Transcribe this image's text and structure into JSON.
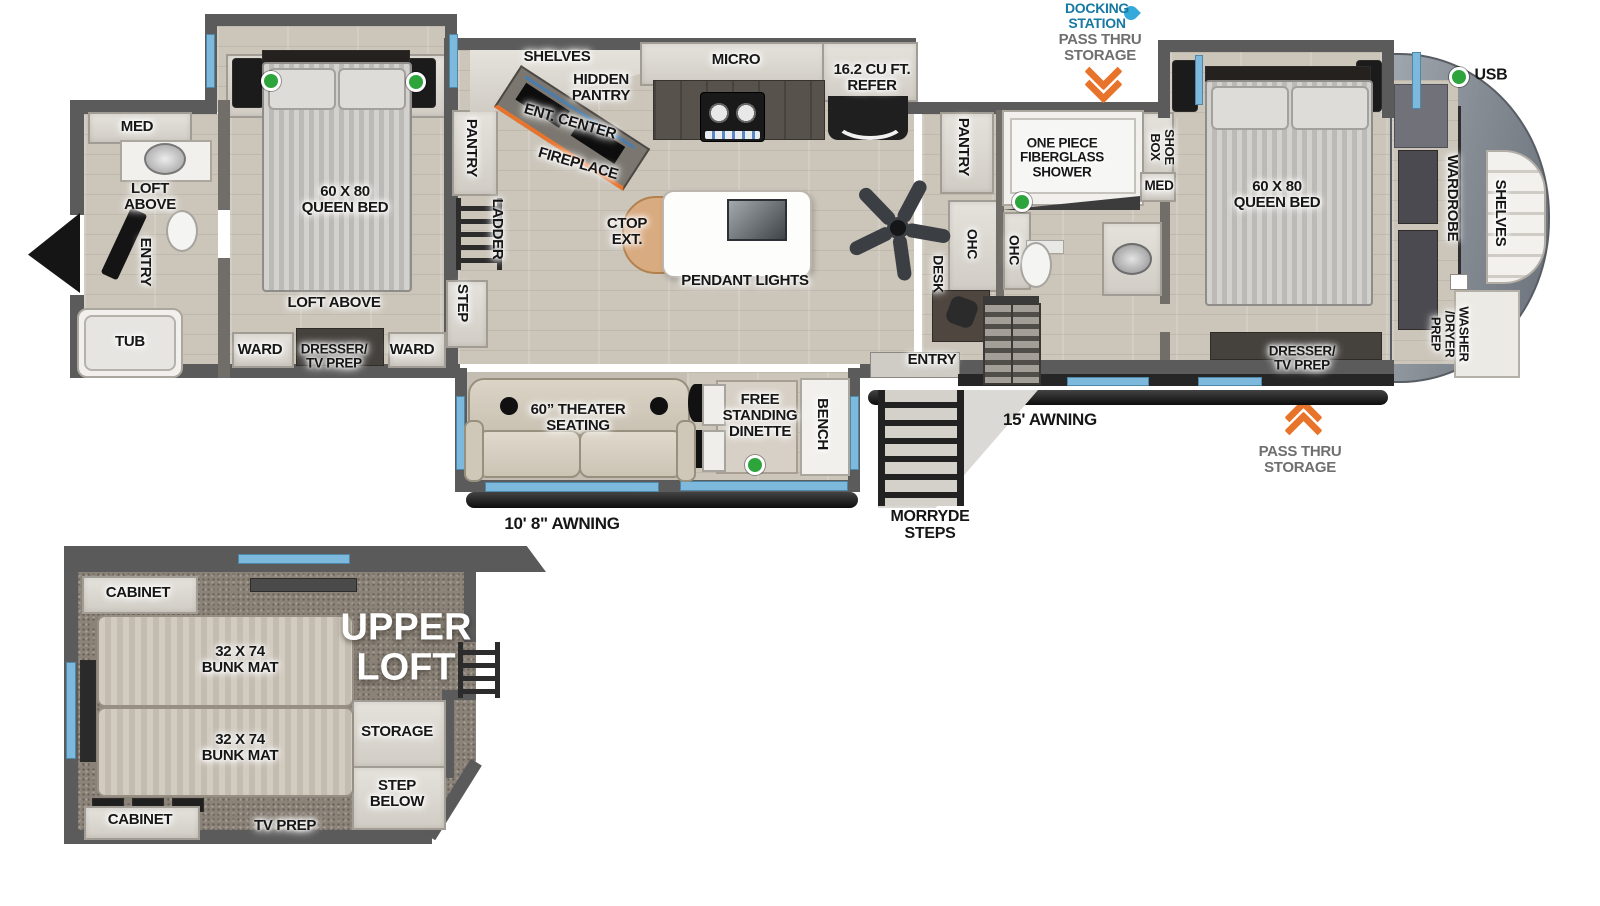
{
  "colors": {
    "accent_blue": "#1779a2",
    "arrow_orange": "#e8742c",
    "indicator_green": "#2ea53c",
    "window_blue": "#7cb9dd",
    "wall_gray": "#5b5b5b"
  },
  "exterior": {
    "docking_station": "DOCKING\nSTATION",
    "pass_thru_storage_top": "PASS THRU\nSTORAGE",
    "usb": "USB",
    "awning_15": "15' AWNING",
    "pass_thru_storage_bottom": "PASS THRU\nSTORAGE",
    "morryde_steps": "MORRYDE\nSTEPS",
    "awning_10": "10' 8\" AWNING"
  },
  "rear_bath": {
    "med": "MED",
    "loft_above": "LOFT\nABOVE",
    "entry": "ENTRY",
    "tub": "TUB"
  },
  "rear_bedroom": {
    "queen_bed": "60 X 80\nQUEEN BED",
    "loft_above": "LOFT ABOVE",
    "ward_left": "WARD",
    "dresser_tv": "DRESSER/\nTV PREP",
    "ward_right": "WARD"
  },
  "passage": {
    "pantry": "PANTRY",
    "ladder": "LADDER",
    "step": "STEP"
  },
  "kitchen": {
    "shelves": "SHELVES",
    "hidden_pantry": "HIDDEN\nPANTRY",
    "ent_center": "ENT. CENTER",
    "fireplace": "FIREPLACE",
    "micro": "MICRO",
    "refer": "16.2 CU FT.\nREFER",
    "ctop_ext": "CTOP\nEXT.",
    "pendant_lights": "PENDANT LIGHTS"
  },
  "mid_bath": {
    "pantry": "PANTRY",
    "ohc_left": "OHC",
    "desk": "DESK",
    "ohc_right": "OHC",
    "shower": "ONE PIECE\nFIBERGLASS\nSHOWER",
    "shoe_box": "SHOE\nBOX",
    "med": "MED",
    "entry": "ENTRY"
  },
  "living_slide": {
    "theater_seating": "60” THEATER\nSEATING",
    "dinette": "FREE\nSTANDING\nDINETTE",
    "bench": "BENCH"
  },
  "front_bedroom": {
    "queen_bed": "60 X 80\nQUEEN BED",
    "dresser_tv": "DRESSER/\nTV PREP",
    "wardrobe": "WARDROBE",
    "shelves": "SHELVES",
    "washer_dryer": "WASHER\n/DRYER\nPREP"
  },
  "upper_loft": {
    "cabinet_top": "CABINET",
    "bunk_top": "32 X 74\nBUNK MAT",
    "bunk_bottom": "32 X 74\nBUNK MAT",
    "title": "UPPER\nLOFT",
    "storage": "STORAGE",
    "step_below": "STEP\nBELOW",
    "cabinet_bottom": "CABINET",
    "tv_prep": "TV PREP"
  }
}
